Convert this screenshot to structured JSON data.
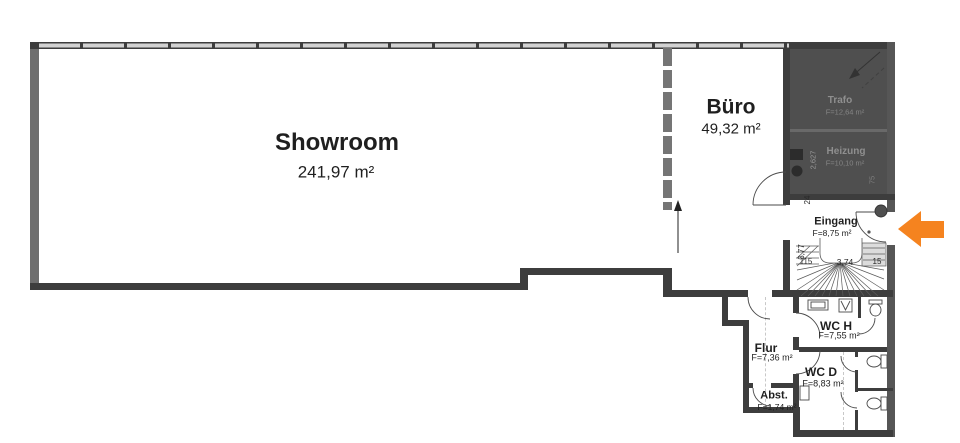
{
  "rooms": {
    "showroom": {
      "name": "Showroom",
      "area": "241,97 m²"
    },
    "buero": {
      "name": "Büro",
      "area": "49,32 m²"
    },
    "trafo": {
      "name": "Trafo",
      "area": "F=12,64 m²"
    },
    "heizung": {
      "name": "Heizung",
      "area": "F=10,10 m²"
    },
    "eingang": {
      "name": "Eingang",
      "area": "F=8,75 m²"
    },
    "flur": {
      "name": "Flur",
      "area": "F=7,36 m²"
    },
    "wc_h": {
      "name": "WC H",
      "area": "F=7,55 m²"
    },
    "wc_d": {
      "name": "WC D",
      "area": "F=8,83 m²"
    },
    "abst": {
      "name": "Abst.",
      "area": "F=1,74 m²"
    }
  },
  "dimensions": {
    "heizung_depth": "2,627",
    "wall_24": "24",
    "stair_side": "3,77",
    "stair_left": "115",
    "stair_width": "3,74",
    "stair_right": "15",
    "heizung_75": "75"
  },
  "colors": {
    "wall_dark": "#3d3d3d",
    "wall_gray": "#6e6e6e",
    "dark_room_fill": "#4f4f4f",
    "entrance_arrow_orange": "#F5831F"
  }
}
